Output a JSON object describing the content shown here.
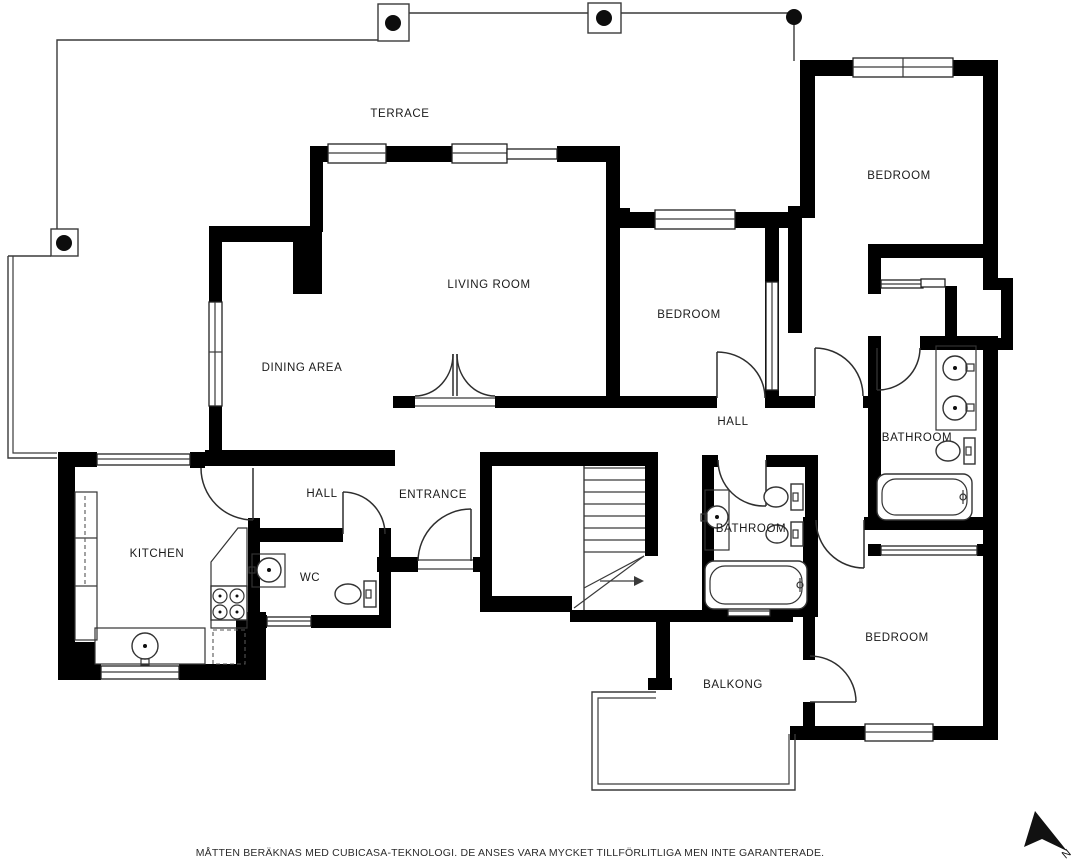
{
  "page": {
    "background": "#ffffff"
  },
  "rooms": {
    "terrace": {
      "label": "TERRACE"
    },
    "living_room": {
      "label": "LIVING ROOM"
    },
    "dining_area": {
      "label": "DINING AREA"
    },
    "bedroom_top_right": {
      "label": "BEDROOM"
    },
    "bedroom_middle": {
      "label": "BEDROOM"
    },
    "bedroom_bottom": {
      "label": "BEDROOM"
    },
    "hall_upper": {
      "label": "HALL"
    },
    "hall_entrance": {
      "label": "HALL"
    },
    "entrance": {
      "label": "ENTRANCE"
    },
    "kitchen": {
      "label": "KITCHEN"
    },
    "wc": {
      "label": "WC"
    },
    "bathroom_right": {
      "label": "BATHROOM"
    },
    "bathroom_middle": {
      "label": "BATHROOM"
    },
    "balcony": {
      "label": "BALKONG"
    }
  },
  "compass": {
    "label": "N"
  },
  "footer": {
    "disclaimer": "MÅTTEN BERÄKNAS MED CUBICASA-TEKNOLOGI. DE ANSES VARA MYCKET TILLFÖRLITLIGA MEN INTE GARANTERADE."
  },
  "colors": {
    "wall": "#000000",
    "line": "#3a3a3a",
    "background": "#ffffff",
    "text": "#1a1a1a"
  }
}
